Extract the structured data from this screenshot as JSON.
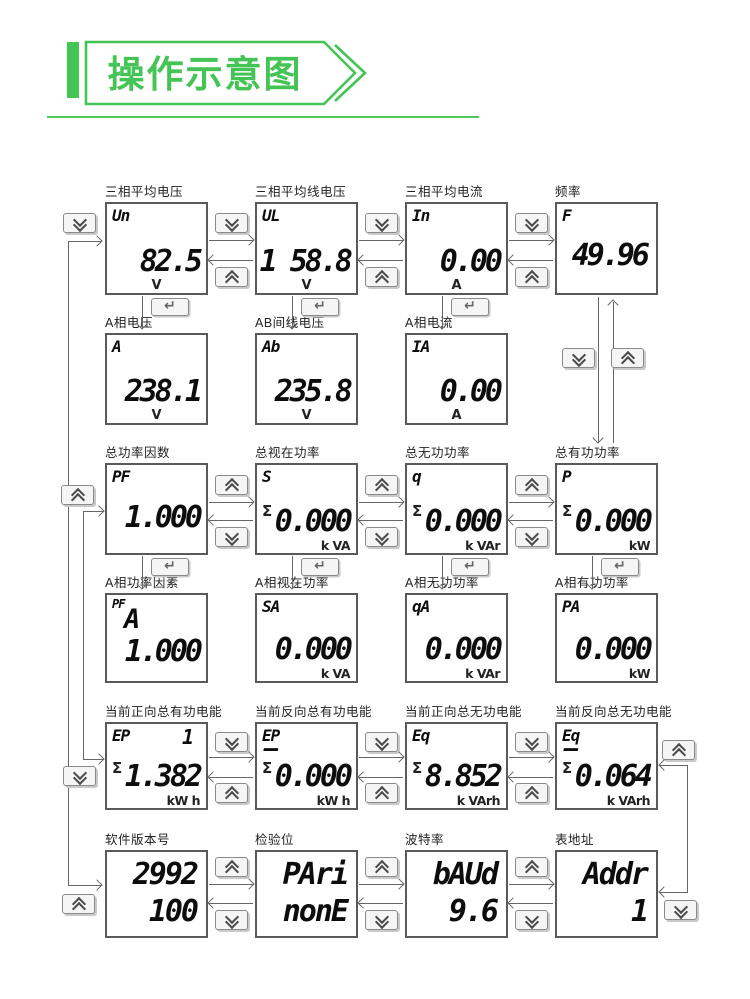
{
  "header": {
    "title": "操作示意图"
  },
  "colors": {
    "green": "#43c454",
    "line": "#666666",
    "digit": "#0d0d0d",
    "panel_border": "#5a5a5a"
  },
  "icons": {
    "scroll_down": "double-chevron-down",
    "scroll_up": "double-chevron-up",
    "enter": "return-arrow",
    "banner": "right-chevron-banner"
  },
  "rows": [
    {
      "cells": [
        {
          "title": "三相平均电压",
          "label": "Un",
          "value": "82.5",
          "unit": "V"
        },
        {
          "title": "三相平均线电压",
          "label": "UL",
          "value": "1 58.8",
          "unit": "V"
        },
        {
          "title": "三相平均电流",
          "label": "In",
          "value": "0.00",
          "unit": "A"
        },
        {
          "title": "频率",
          "label": "F",
          "value": "49.96",
          "unit": ""
        }
      ]
    },
    {
      "cells": [
        {
          "title": "A相电压",
          "label": "A",
          "value": "238.1",
          "unit": "V"
        },
        {
          "title": "AB间线电压",
          "label": "Ab",
          "value": "235.8",
          "unit": "V"
        },
        {
          "title": "A相电流",
          "label": "IA",
          "value": "0.00",
          "unit": "A"
        }
      ]
    },
    {
      "cells": [
        {
          "title": "总功率因数",
          "label": "PF",
          "value": "1.000",
          "unit": ""
        },
        {
          "title": "总视在功率",
          "label": "S",
          "sigma": "Σ",
          "value": "0.000",
          "unit": "k VA"
        },
        {
          "title": "总无功功率",
          "label": "q",
          "sigma": "Σ",
          "value": "0.000",
          "unit": "k VAr"
        },
        {
          "title": "总有功功率",
          "label": "P",
          "sigma": "Σ",
          "value": "0.000",
          "unit": "kW"
        }
      ]
    },
    {
      "cells": [
        {
          "title": "A相功率因素",
          "label": "PF",
          "label2": "A",
          "value": "1.000",
          "unit": ""
        },
        {
          "title": "A相视在功率",
          "label": "SA",
          "value": "0.000",
          "unit": "k VA"
        },
        {
          "title": "A相无功功率",
          "label": "qA",
          "value": "0.000",
          "unit": "k VAr"
        },
        {
          "title": "A相有功功率",
          "label": "PA",
          "value": "0.000",
          "unit": "kW"
        }
      ]
    },
    {
      "cells": [
        {
          "title": "当前正向总有功电能",
          "label": "EP",
          "tariff": "1",
          "sigma": "Σ",
          "value": "1.382",
          "unit": "kW h"
        },
        {
          "title": "当前反向总有功电能",
          "label": "EP",
          "minus": "–",
          "sigma": "Σ",
          "value": "0.000",
          "unit": "kW h"
        },
        {
          "title": "当前正向总无功电能",
          "label": "Eq",
          "sigma": "Σ",
          "value": "8.852",
          "unit": "k VArh"
        },
        {
          "title": "当前反向总无功电能",
          "label": "Eq",
          "minus": "–",
          "sigma": "Σ",
          "value": "0.064",
          "unit": "k VArh"
        }
      ]
    },
    {
      "cells": [
        {
          "title": "软件版本号",
          "line1": "2992",
          "line2": "100"
        },
        {
          "title": "检验位",
          "line1": "PAri",
          "line2": "nonE"
        },
        {
          "title": "波特率",
          "line1": "bAUd",
          "line2": "9.6"
        },
        {
          "title": "表地址",
          "line1": "Addr",
          "line2": "1"
        }
      ]
    }
  ]
}
